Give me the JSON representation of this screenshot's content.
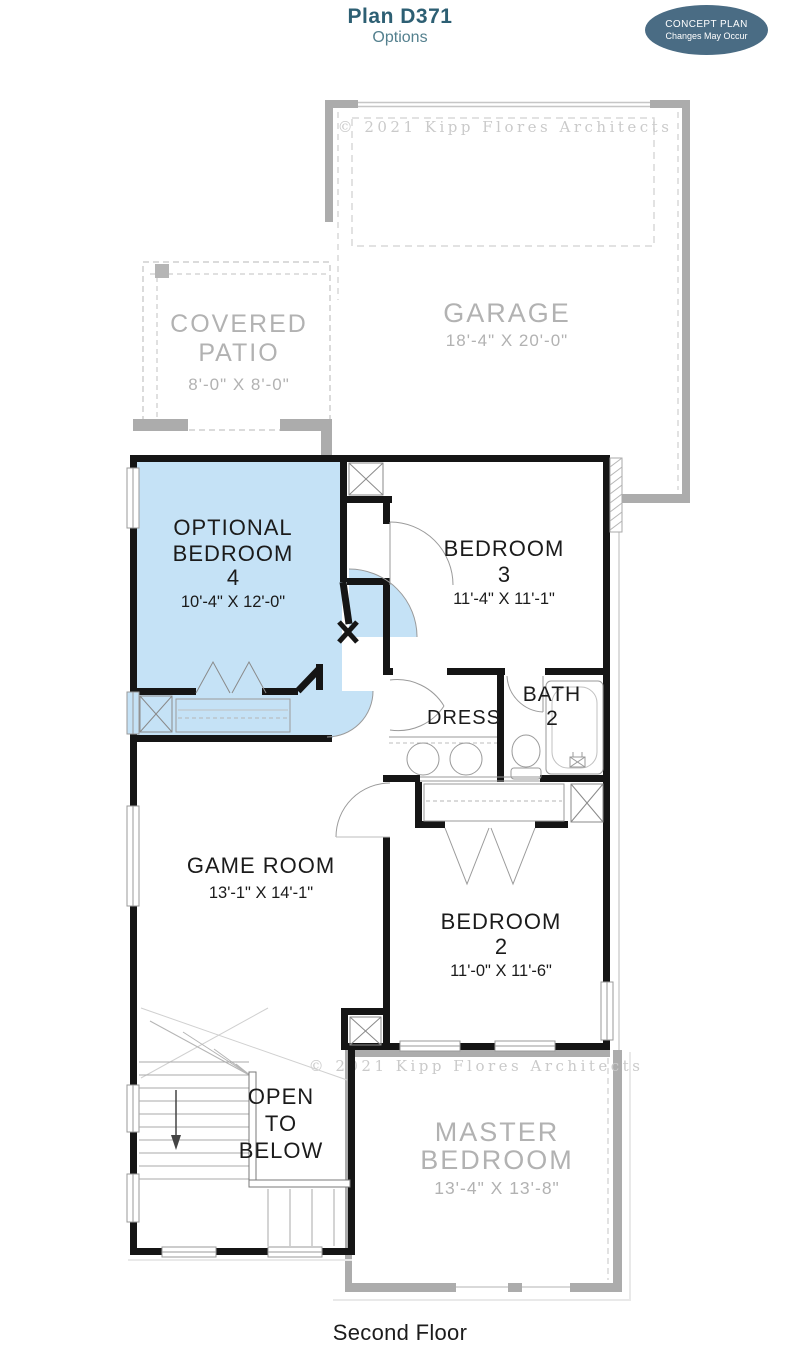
{
  "page": {
    "title": "Plan D371",
    "subtitle": "Options",
    "footer": "Second Floor"
  },
  "badge": {
    "line1": "CONCEPT PLAN",
    "line2": "Changes May Occur"
  },
  "watermark": {
    "text": "© 2021 Kipp Flores Architects"
  },
  "colors": {
    "title_accent": "#2D5F73",
    "badge_bg": "#4A6C84",
    "highlight_blue": "#C5E2F6",
    "first_floor_gray": "#ACACAC",
    "gray_label": "#B2B2B2",
    "watermark_gray": "#CACACA",
    "wall_black": "#151515"
  },
  "rooms": {
    "optional_bedroom4": {
      "line1": "OPTIONAL",
      "line2": "BEDROOM",
      "line3": "4",
      "dims": "10'-4\" X 12'-0\""
    },
    "bedroom3": {
      "line1": "BEDROOM",
      "line2": "3",
      "dims": "11'-4\" X 11'-1\""
    },
    "dress": {
      "line1": "DRESS"
    },
    "bath2": {
      "line1": "BATH",
      "line2": "2"
    },
    "game_room": {
      "line1": "GAME ROOM",
      "dims": "13'-1\" X 14'-1\""
    },
    "bedroom2": {
      "line1": "BEDROOM",
      "line2": "2",
      "dims": "11'-0\" X 11'-6\""
    },
    "open_to_below": {
      "line1": "OPEN",
      "line2": "TO",
      "line3": "BELOW"
    },
    "garage": {
      "line1": "GARAGE",
      "dims": "18'-4\" X 20'-0\""
    },
    "covered_patio": {
      "line1": "COVERED",
      "line2": "PATIO",
      "dims": "8'-0\" X 8'-0\""
    },
    "master_bedroom": {
      "line1": "MASTER",
      "line2": "BEDROOM",
      "dims": "13'-4\" X 13'-8\""
    }
  }
}
